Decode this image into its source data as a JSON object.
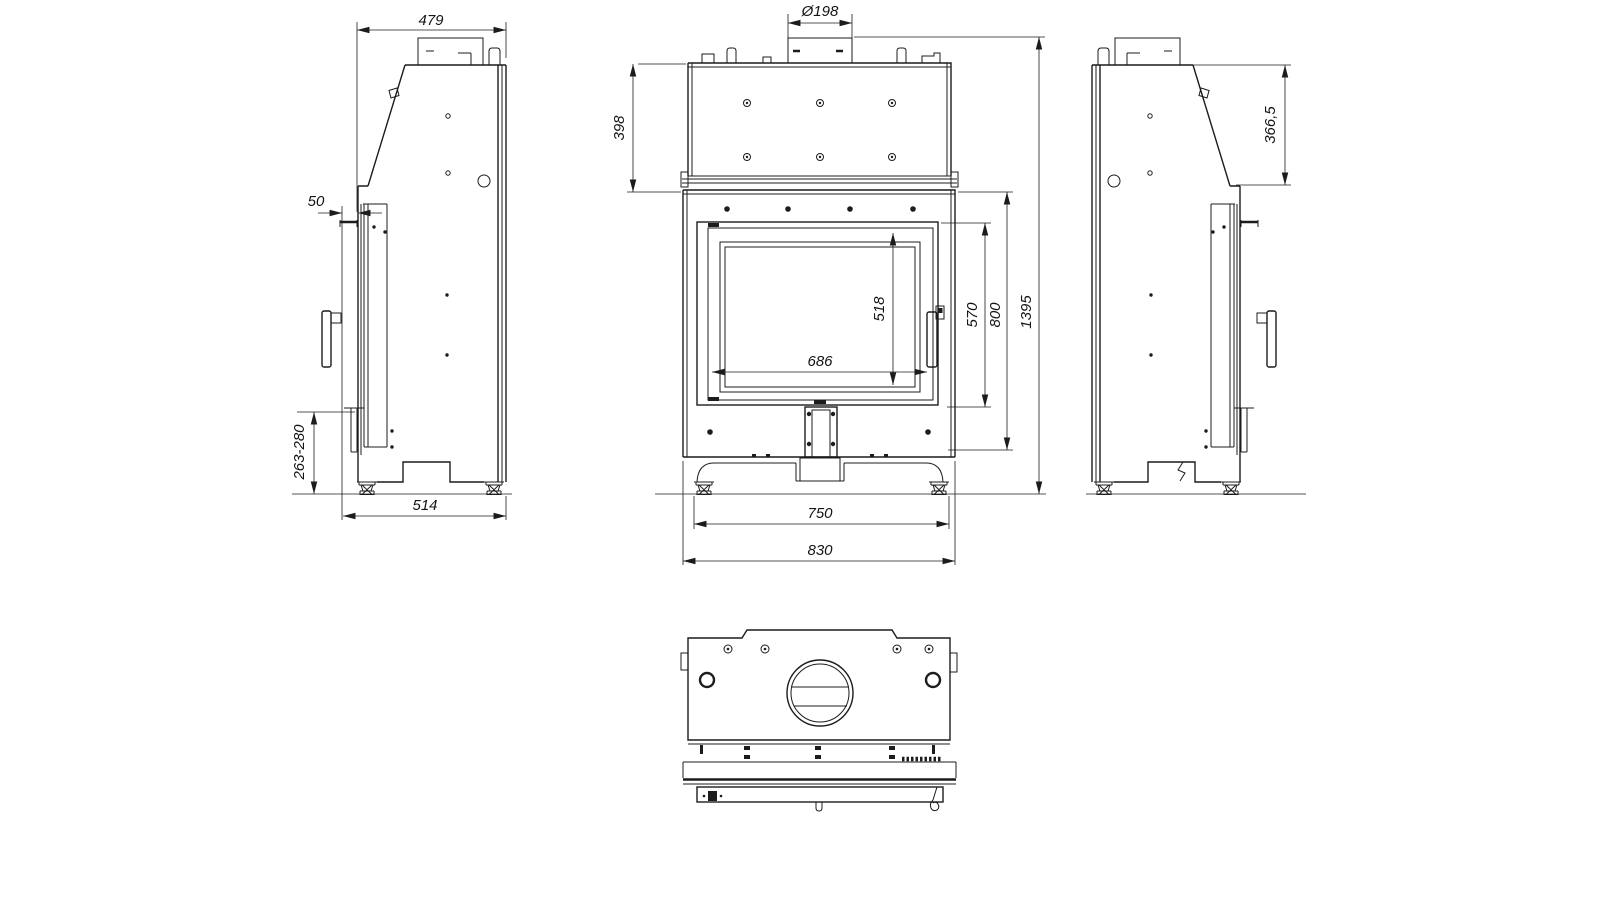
{
  "drawing": {
    "colors": {
      "background": "#ffffff",
      "line": "#1c1c1c"
    },
    "views": {
      "side_left": {
        "dims": {
          "top_depth": "479",
          "door_offset": "50",
          "outlet_height_range": "263-280",
          "base_depth": "514"
        }
      },
      "front": {
        "dims": {
          "flue_diameter": "Ø198",
          "exchanger_height": "398",
          "glass_height": "518",
          "glass_width": "686",
          "door_height": "570",
          "body_height": "800",
          "total_height": "1395",
          "feet_spacing": "750",
          "total_width": "830"
        }
      },
      "side_right": {
        "dims": {
          "hood_slope_height": "366,5"
        }
      }
    }
  }
}
